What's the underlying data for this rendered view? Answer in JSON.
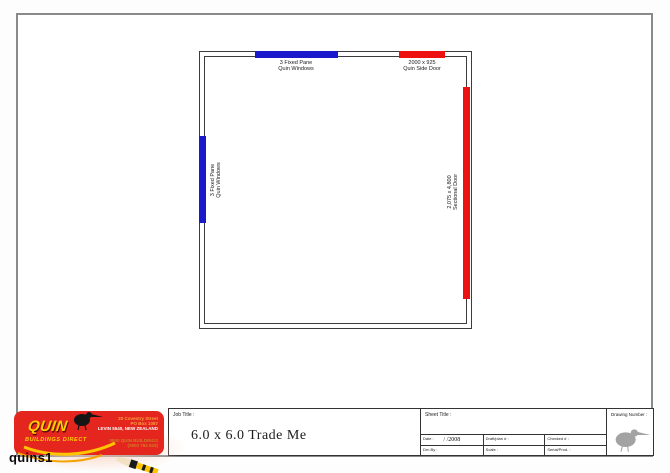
{
  "caption": "quins1",
  "colors": {
    "window_blue": "#1a1acc",
    "door_red": "#ee1111",
    "logo_red": "#e4261f",
    "logo_yellow": "#ffcf00",
    "border_gray": "#8a8a8a"
  },
  "plan": {
    "top_window": {
      "line1": "3 Fixed Pane",
      "line2": "Quin Windows"
    },
    "top_door": {
      "line1": "2000 x 925",
      "line2": "Quin Side Door"
    },
    "left_window": {
      "line1": "3 Fixed Pane",
      "line2": "Quin Windows"
    },
    "right_door": {
      "line1": "2,075 x 4,800",
      "line2": "Sectional Door"
    }
  },
  "title_block": {
    "job_title_label": "Job Title :",
    "job_title": "6.0 x 6.0 Trade Me",
    "sheet_title_label": "Sheet Title :",
    "drawing_number_label": "Drawing Number :",
    "fields": {
      "date_label": "Date :",
      "date_value": "/ /2008",
      "plan_no_label": "Draft/plan # :",
      "checked_label": "Checked # :",
      "drawn_by_label": "Drn By :",
      "scale_label": "Scale :",
      "serial_label": "Serial/Prod. :"
    }
  },
  "logo": {
    "brand": "QUIN",
    "brand_sub": "BUILDINGS DIRECT",
    "address_line1": "20 Coventry Street",
    "address_line2": "PO Box 1087",
    "address_line3": "LEVIN 5540, NEW ZEALAND",
    "phone_line1": "0800 QUIN BUILDINGS",
    "phone_line2": "(0800 784 628)"
  }
}
